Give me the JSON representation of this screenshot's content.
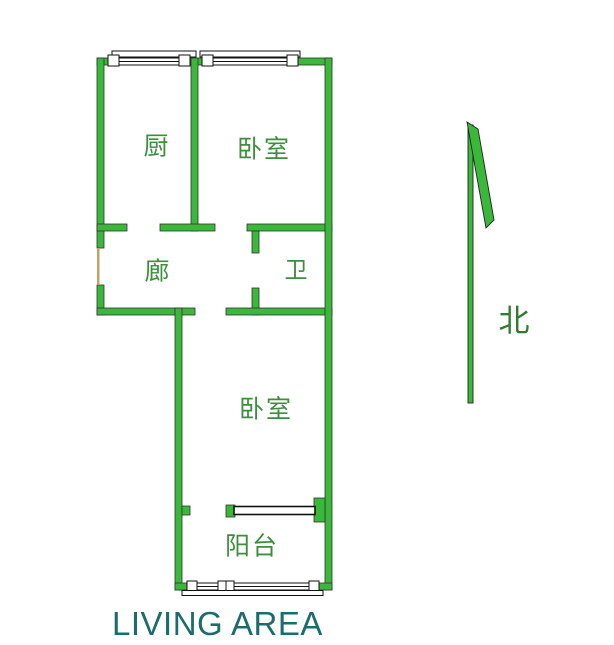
{
  "floorplan": {
    "rooms": [
      {
        "id": "kitchen",
        "label": "厨"
      },
      {
        "id": "bedroom-north",
        "label": "卧室"
      },
      {
        "id": "corridor",
        "label": "廊"
      },
      {
        "id": "bathroom",
        "label": "卫"
      },
      {
        "id": "bedroom-south",
        "label": "卧室"
      },
      {
        "id": "balcony",
        "label": "阳台"
      }
    ],
    "compass": {
      "label": "北",
      "direction": "north"
    },
    "caption": "LIVING AREA",
    "colors": {
      "wall": "#3ab83a",
      "wall_outline": "#333333",
      "room_label": "#3c8f3c",
      "compass_label": "#2e7d2e",
      "caption": "#1c6b6d",
      "door_marker": "#c9a063",
      "window_fill": "#ffffff",
      "window_line": "#111111"
    }
  }
}
